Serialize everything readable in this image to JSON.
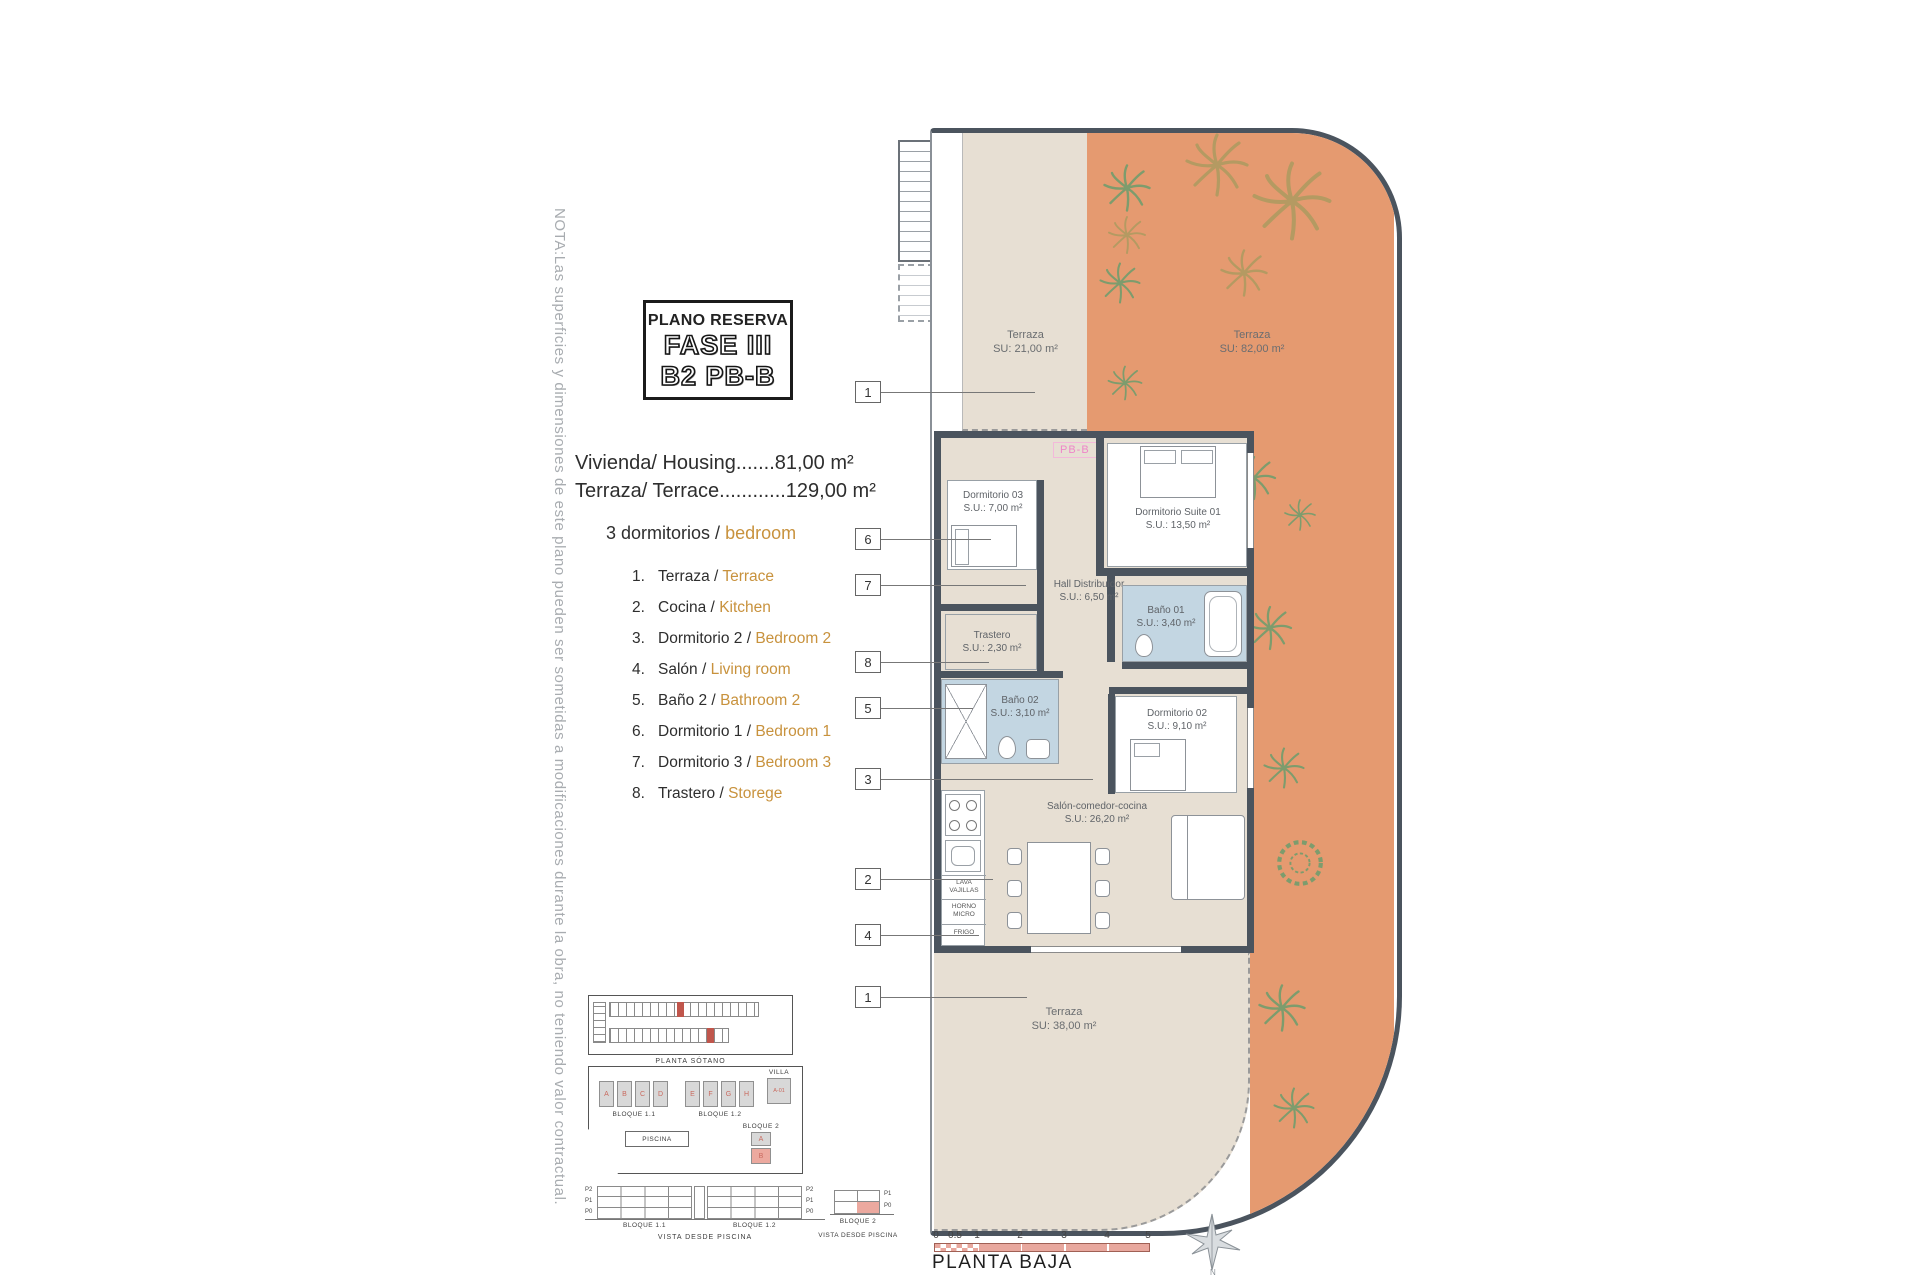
{
  "note": "NOTA:Las superficies y dimensiones de este plano pueden ser sometidas a modificaciones durante la obra, no teniendo valor contractual.",
  "title_block": {
    "line1": "PLANO RESERVA",
    "line2": "FASE III",
    "line3": "B2 PB-B"
  },
  "areas": {
    "housing": "Vivienda/ Housing.......81,00 m²",
    "terrace": "Terraza/ Terrace............129,00 m²"
  },
  "bedrooms_line": {
    "es": "3 dormitorios /",
    "en": "bedroom"
  },
  "legend": {
    "items": [
      {
        "n": "1.",
        "es": "Terraza /",
        "en": "Terrace"
      },
      {
        "n": "2.",
        "es": "Cocina /",
        "en": "Kitchen"
      },
      {
        "n": "3.",
        "es": "Dormitorio 2 /",
        "en": "Bedroom 2"
      },
      {
        "n": "4.",
        "es": "Salón /",
        "en": "Living room"
      },
      {
        "n": "5.",
        "es": "Baño 2 /",
        "en": "Bathroom 2"
      },
      {
        "n": "6.",
        "es": "Dormitorio 1 /",
        "en": "Bedroom 1"
      },
      {
        "n": "7.",
        "es": "Dormitorio 3 /",
        "en": "Bedroom 3"
      },
      {
        "n": "8.",
        "es": "Trastero /",
        "en": "Storege"
      }
    ]
  },
  "plan": {
    "unit_tag": "PB-B",
    "rooms": [
      {
        "name": "Terraza",
        "area": "SU: 21,00 m²"
      },
      {
        "name": "Terraza",
        "area": "SU: 82,00 m²"
      },
      {
        "name": "Dormitorio Suite 01",
        "area": "S.U.: 13,50 m²"
      },
      {
        "name": "Dormitorio 03",
        "area": "S.U.: 7,00 m²"
      },
      {
        "name": "Hall Distribuidor",
        "area": "S.U.: 6,50 m²"
      },
      {
        "name": "Baño 01",
        "area": "S.U.: 3,40 m²"
      },
      {
        "name": "Trastero",
        "area": "S.U.: 2,30 m²"
      },
      {
        "name": "Baño 02",
        "area": "S.U.: 3,10 m²"
      },
      {
        "name": "Dormitorio 02",
        "area": "S.U.: 9,10 m²"
      },
      {
        "name": "Salón-comedor-cocina",
        "area": "S.U.: 26,20 m²"
      },
      {
        "name": "Terraza",
        "area": "SU: 38,00 m²"
      }
    ],
    "kitchen_labels": [
      "LAVA VAJILLAS",
      "HORNO MICRO",
      "FRIGO"
    ],
    "callouts": [
      "1",
      "6",
      "7",
      "8",
      "5",
      "3",
      "2",
      "4",
      "1"
    ]
  },
  "site": {
    "sotano_label": "PLANTA SÓTANO",
    "bloque11": "BLOQUE 1.1",
    "bloque12": "BLOQUE 1.2",
    "villa": "VILLA",
    "bloque2": "BLOQUE 2",
    "piscina": "PISCINA",
    "units_b11": [
      "A",
      "B",
      "C",
      "D"
    ],
    "units_b12": [
      "E",
      "F",
      "G",
      "H"
    ],
    "units_b2": [
      "A",
      "B"
    ],
    "villa_unit": "A-01",
    "floor_labels": [
      "P2",
      "P1",
      "P0"
    ],
    "floor_labels_b2": [
      "P1",
      "P0"
    ],
    "vista_label": "VISTA DESDE PISCINA"
  },
  "footer": {
    "scale_ticks": [
      "0",
      "0.5",
      "1",
      "2",
      "3",
      "4",
      "5"
    ],
    "plan_label": "PLANTA BAJA",
    "compass": "N"
  },
  "colors": {
    "terrace_orange": "#e59a70",
    "floor_beige": "#e7dfd3",
    "wall_dark": "#4b545e",
    "bath_blue": "#c3d6e2",
    "accent_text_orange": "#c8923d",
    "highlight_pink": "#eca99f",
    "unit_tag_pink": "#ee86c8",
    "note_gray": "#a8acb0"
  }
}
